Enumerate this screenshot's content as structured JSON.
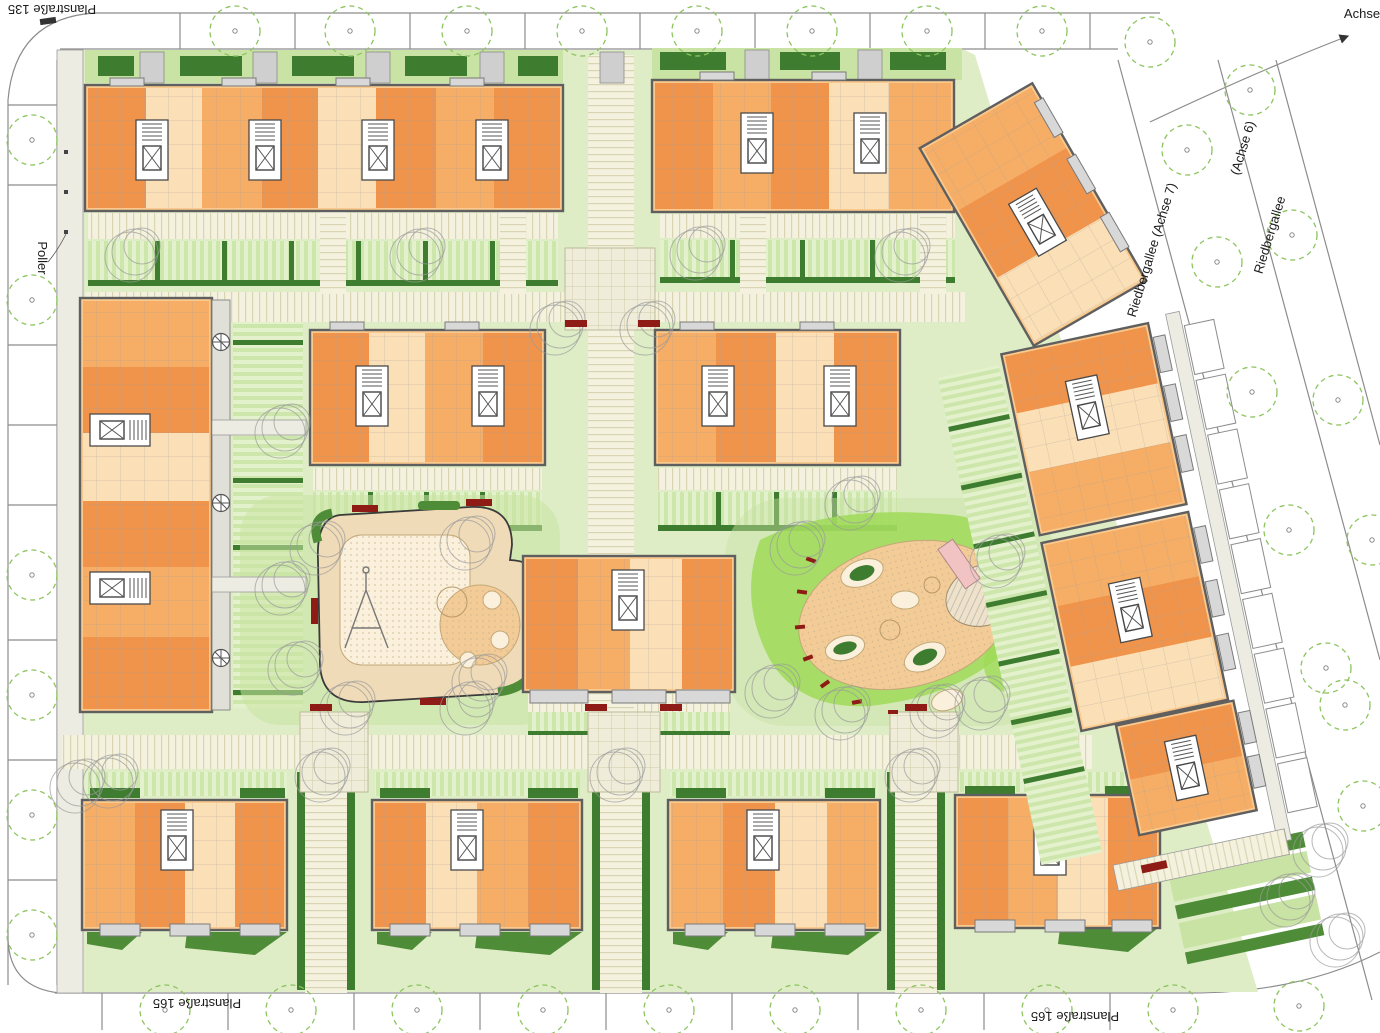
{
  "labels": {
    "street_top": "Planstraße 135",
    "street_bottom_left": "Planstraße 165",
    "street_bottom_right": "Planstraße 165",
    "bollard_note": "Poller",
    "axis_note": "Achse",
    "avenue_axis7": "Riedbergallee (Achse 7)",
    "avenue_name6": "Riedbergallee",
    "avenue_axis6": "(Achse 6)"
  },
  "colors": {
    "apt_dark": "#F0944C",
    "apt_mid": "#F6AE66",
    "apt_light": "#F9C98E",
    "apt_pale": "#FBDFB6",
    "wall": "#5F5F5F",
    "lawn": "#DEEDC6",
    "lawn_med": "#C8E3A3",
    "stripe_light": "#E4F1CD",
    "stripe_med": "#CDE6AB",
    "hedge": "#4E8C38",
    "hedge_dark": "#3E7D2F",
    "grass_bright": "#9FDB58",
    "path": "#F4F2DF",
    "path_line": "#D9D5B2",
    "plaza": "#EFEDDA",
    "plaza_line": "#CFCBA8",
    "sand": "#F0DBB8",
    "sand_orange": "#F3CB97",
    "sand_pale": "#FAF0DC",
    "bench": "#8E1B15",
    "street_line": "#8C8C8C",
    "tree_green": "#8CC45E",
    "tree_gray": "#9A9A9A",
    "balcony": "#D8D8D8",
    "walk": "#EDECE2",
    "entry": "#CFCFCF",
    "slide_pink": "#F2C3C3"
  }
}
